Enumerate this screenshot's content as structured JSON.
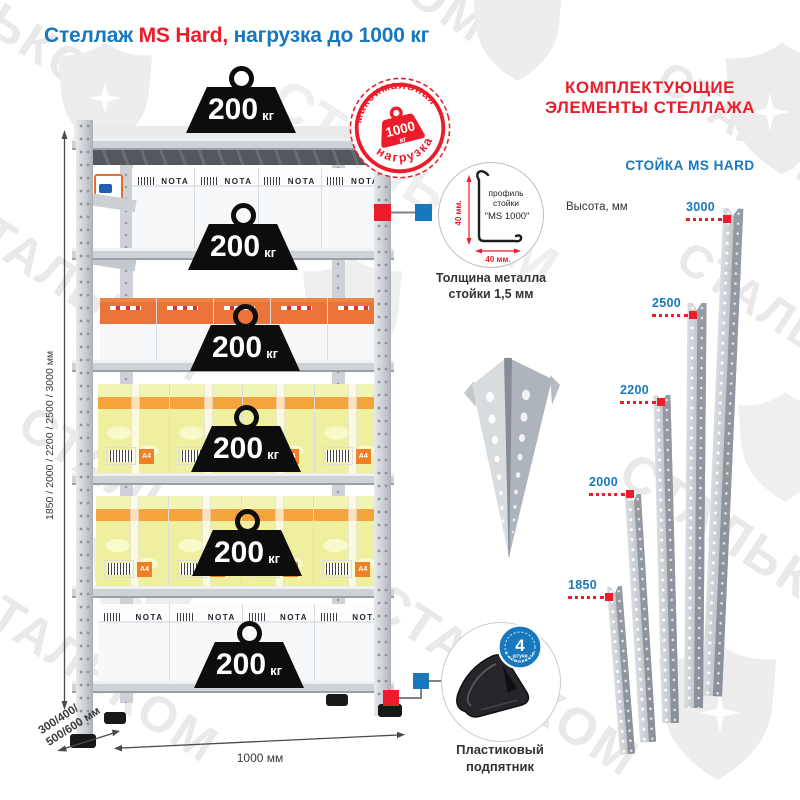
{
  "title": {
    "part_blue_1": "Стеллаж ",
    "part_red": "MS Hard,",
    "part_blue_2": " нагрузка до 1000 кг"
  },
  "watermark": {
    "text": "СТАЛЬКОМ"
  },
  "rack": {
    "weights": [
      {
        "value": "200",
        "unit": "кг"
      },
      {
        "value": "200",
        "unit": "кг"
      },
      {
        "value": "200",
        "unit": "кг"
      },
      {
        "value": "200",
        "unit": "кг"
      },
      {
        "value": "200",
        "unit": "кг"
      },
      {
        "value": "200",
        "unit": "кг"
      }
    ],
    "max_load_badge": {
      "arc_top": "максимальная",
      "arc_bottom": "нагрузка",
      "value": "1000",
      "unit": "кг"
    },
    "box_brand": "NOTA",
    "a4_label": "A4",
    "dim_height": "1850 / 2000 / 2200 / 2500 / 3000 мм",
    "dim_width": "1000 мм",
    "dim_depth_line1": "300/400/",
    "dim_depth_line2": "500/600 мм"
  },
  "components": {
    "profile_circle": {
      "line1": "профиль",
      "line2": "стойки",
      "line3": "\"MS 1000\"",
      "dim_vertical": "40 мм.",
      "dim_horizontal": "40 мм."
    },
    "thickness_note": {
      "line1": "Толщина металла",
      "line2": "стойки 1,5 мм"
    },
    "foot": {
      "label_line1": "Пластиковый",
      "label_line2": "подпятник",
      "badge_count": "4",
      "badge_unit": "штуки",
      "badge_arc": "в комплекте"
    }
  },
  "right_panel": {
    "header_line1": "КОМПЛЕКТУЮЩИЕ",
    "header_line2": "ЭЛЕМЕНТЫ СТЕЛЛАЖА",
    "subheader": "СТОЙКА MS HARD",
    "height_label": "Высота, мм",
    "posts": [
      {
        "height": "3000"
      },
      {
        "height": "2500"
      },
      {
        "height": "2200"
      },
      {
        "height": "2000"
      },
      {
        "height": "1850"
      }
    ]
  },
  "colors": {
    "blue": "#1878be",
    "red": "#ec1c2a",
    "watermark": "#e9e9e9",
    "weight_black": "#0d0d0d"
  }
}
